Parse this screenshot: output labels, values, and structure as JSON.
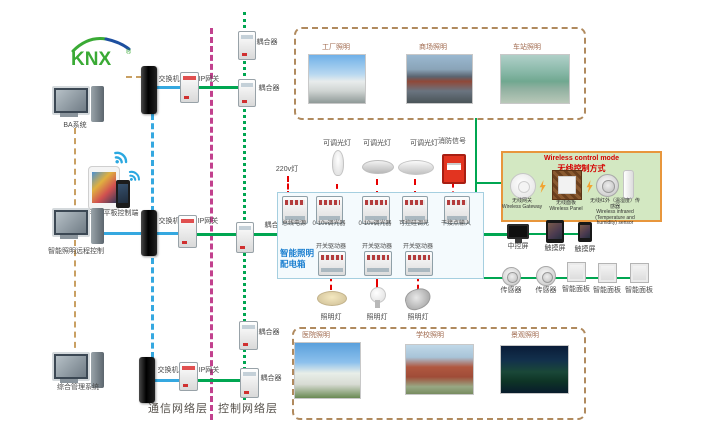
{
  "logo": {
    "text": "KNX",
    "reg": "®"
  },
  "terminals": {
    "ba": "BA系统",
    "mobile": "手机平板控制端",
    "remote": "智能照明远程控制",
    "management": "综合管理系统"
  },
  "labels": {
    "switch": "交换机",
    "ip_gateway": "IP网关",
    "coupler": "耦合器"
  },
  "layers": {
    "communication": "通信网络层",
    "control": "控制网络层"
  },
  "top_buildings": {
    "items": [
      {
        "label": "工厂照明"
      },
      {
        "label": "商场照明"
      },
      {
        "label": "车站照明"
      }
    ]
  },
  "bottom_buildings": {
    "items": [
      {
        "label": "医院照明"
      },
      {
        "label": "学校照明"
      },
      {
        "label": "景观照明"
      }
    ]
  },
  "dist_box": {
    "title1": "智能照明",
    "title2": "配电箱",
    "top_inputs": [
      {
        "label": "220v灯"
      },
      {
        "label": "可调光灯"
      },
      {
        "label": "可调光灯"
      },
      {
        "label": "可调光灯"
      },
      {
        "label": "消防信号"
      }
    ],
    "row1": [
      {
        "label": "总线电源"
      },
      {
        "label": "0-10v调光器"
      },
      {
        "label": "0-10v调光器"
      },
      {
        "label": "可控硅调光"
      },
      {
        "label": "干接点输入"
      }
    ],
    "row2": [
      {
        "label": "开关驱动器"
      },
      {
        "label": "开关驱动器"
      },
      {
        "label": "开关驱动器"
      }
    ],
    "lamps": [
      {
        "label": "照明灯"
      },
      {
        "label": "照明灯"
      },
      {
        "label": "照明灯"
      }
    ]
  },
  "wireless_box": {
    "title_en": "Wireless control mode",
    "title_zh": "无线控制方式",
    "devices": [
      {
        "zh": "无线网关",
        "en": "Wireless Gateway"
      },
      {
        "zh": "无线面板",
        "en": "Wireless Panel"
      },
      {
        "zh": "无线红外（温湿度）传感器",
        "en": "Wireless infrared (Temperature and humidity) sensor"
      }
    ]
  },
  "row_a": [
    {
      "label": "中控屏"
    },
    {
      "label": "触摸屏"
    },
    {
      "label": "触摸屏"
    }
  ],
  "row_b": [
    {
      "label": "传感器"
    },
    {
      "label": "传感器"
    },
    {
      "label": "智能面板"
    },
    {
      "label": "智能面板"
    },
    {
      "label": "智能面板"
    }
  ],
  "colors": {
    "bus_green": "#00a651",
    "line_blue": "#35a8e0",
    "backbone_magenta": "#c2418e",
    "dashed_tan": "#c9a063",
    "signal_red": "#e60000",
    "wireless_border_orange": "#e8963c",
    "wireless_bg_green": "#d3e8c2",
    "box_blue": "#1b7fd0"
  }
}
